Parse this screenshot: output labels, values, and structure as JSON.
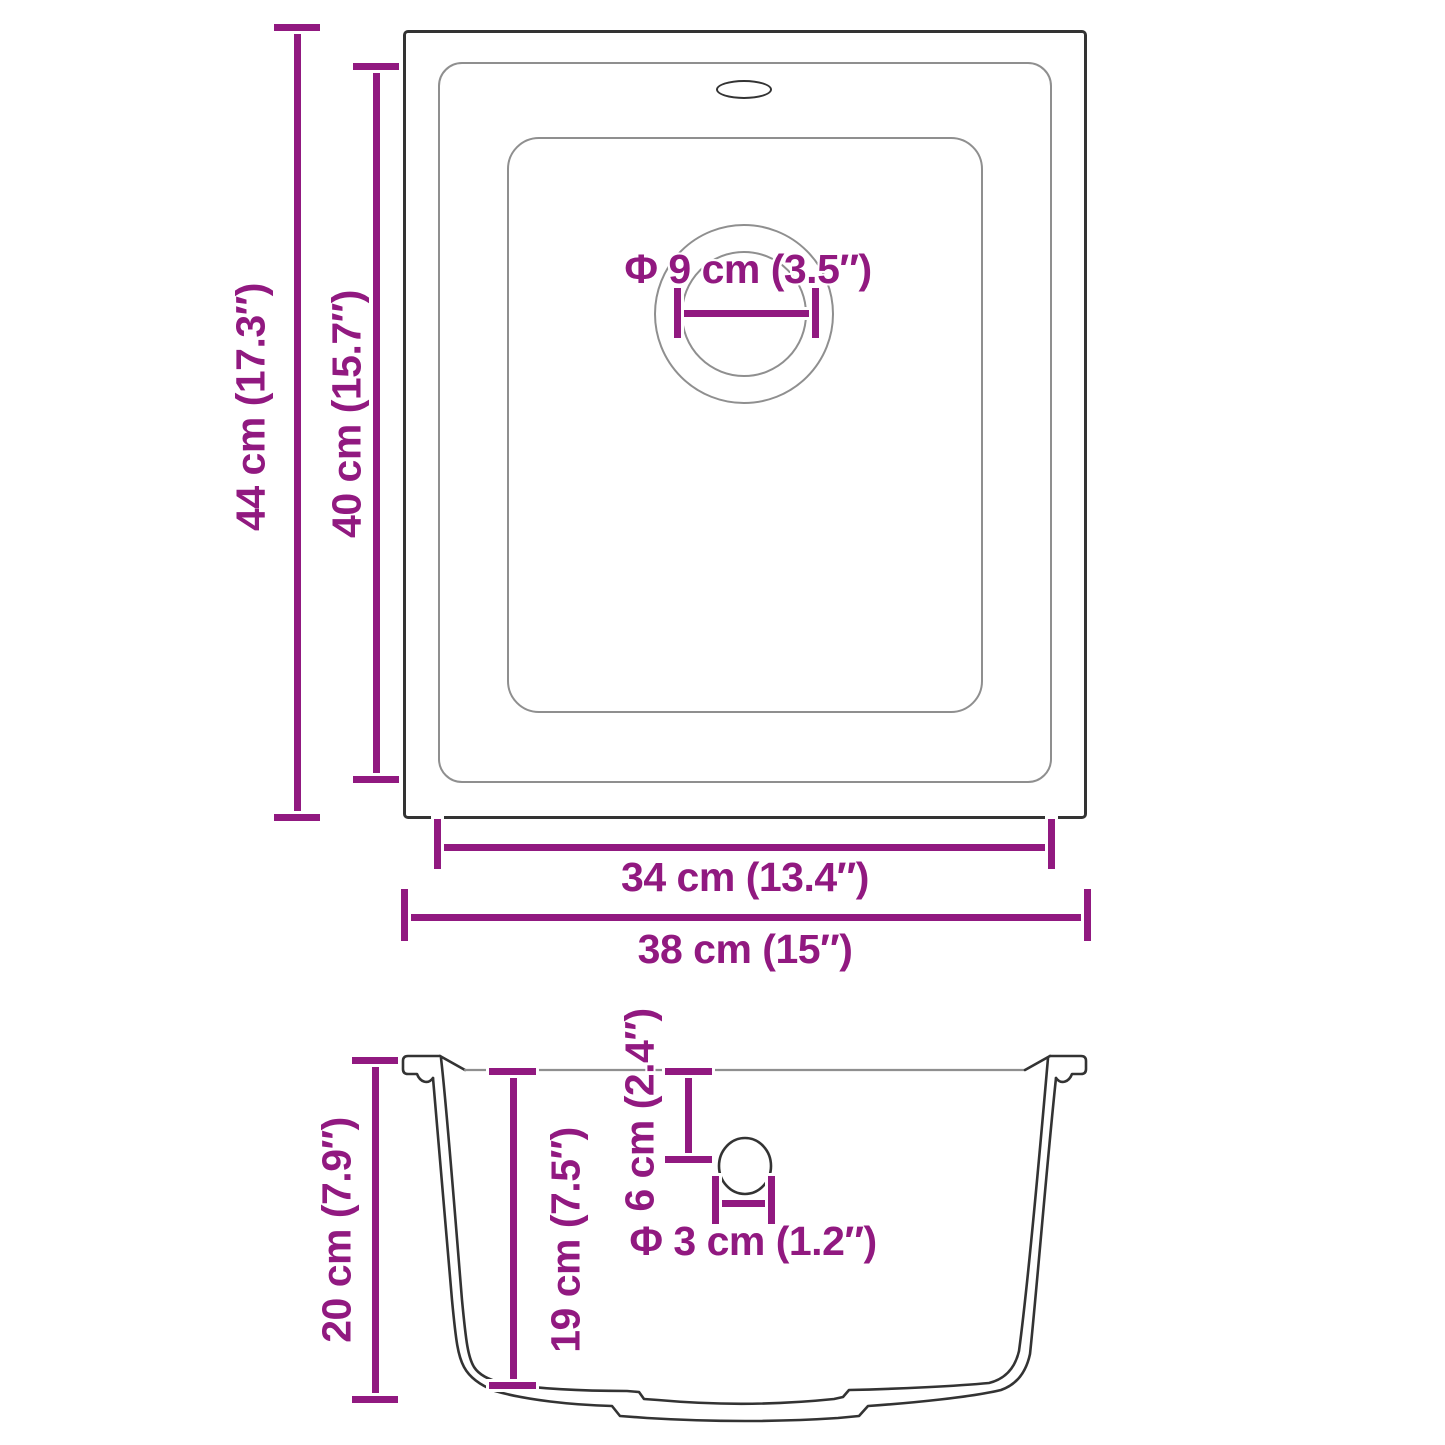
{
  "top_view": {
    "outer_height_label": "44 cm (17.3″)",
    "inner_height_label": "40 cm (15.7″)",
    "inner_width_label": "34 cm (13.4″)",
    "outer_width_label": "38 cm (15″)",
    "drain_diameter_label": "Φ 9 cm (3.5″)"
  },
  "side_view": {
    "outer_depth_label": "20 cm (7.9″)",
    "inner_depth_label": "19 cm (7.5″)",
    "drain_distance_label": "6 cm (2.4″)",
    "drain_hole_label": "Φ 3 cm (1.2″)"
  },
  "colors": {
    "dimension": "#911980",
    "outline": "#333333",
    "secondary_line": "#8f8f8f"
  }
}
